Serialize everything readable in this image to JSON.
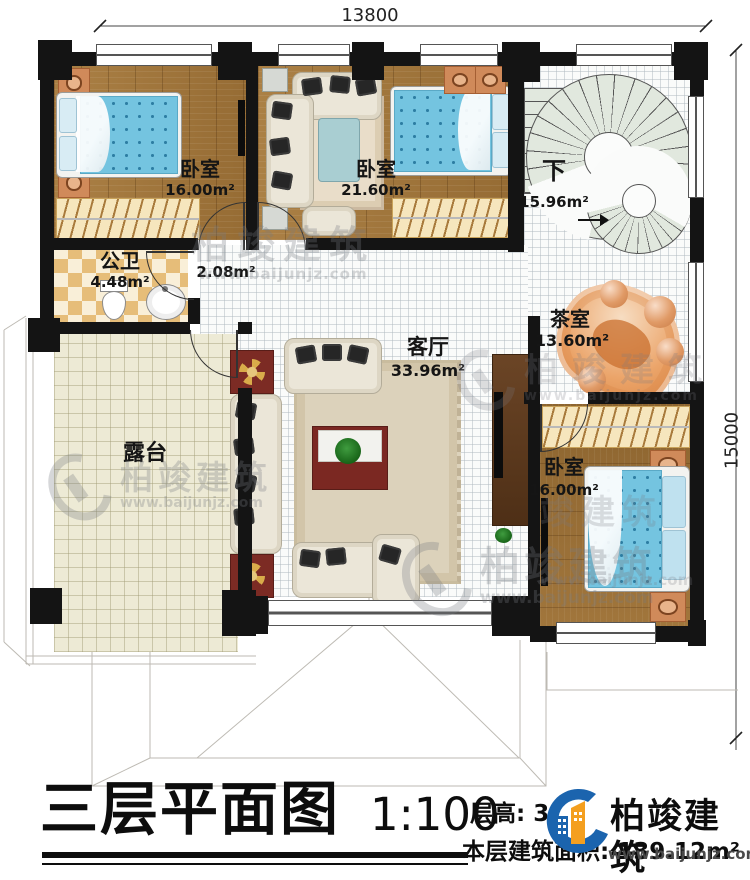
{
  "dimensions": {
    "width": "13800",
    "height": "15000"
  },
  "rooms": {
    "bedroom1": {
      "label": "卧室",
      "area": "16.00m²"
    },
    "bedroom2": {
      "label": "卧室",
      "area": "21.60m²"
    },
    "bedroom3": {
      "label": "卧室",
      "area": "16.00m²"
    },
    "stairwell": {
      "label": "下",
      "area": "15.96m²"
    },
    "bathroom": {
      "label": "公卫",
      "area": "4.48m²"
    },
    "hallway": {
      "area": "2.08m²"
    },
    "living_room": {
      "label": "客厅",
      "area": "33.96m²"
    },
    "tea_room": {
      "label": "茶室",
      "area": "13.60m²"
    },
    "terrace": {
      "label": "露台"
    }
  },
  "title_block": {
    "title": "三层平面图",
    "scale": "1:100",
    "floor_height": "层高: 3.",
    "floor_area": "本层建筑面积: 139.12m²"
  },
  "logo": {
    "company": "柏竣建筑",
    "website": "www.baijunjz.com"
  },
  "watermark": {
    "company": "柏竣建筑",
    "partial": "竣建筑",
    "website": "www.baijunjz.com"
  },
  "colors": {
    "wall": "#141414",
    "wood_floor": "#a0763c",
    "bed_blue": "#72c3e2",
    "stair_tread": "#e1e8de",
    "logo_blue": "#1b64ae",
    "logo_orange": "#f49f1f"
  }
}
